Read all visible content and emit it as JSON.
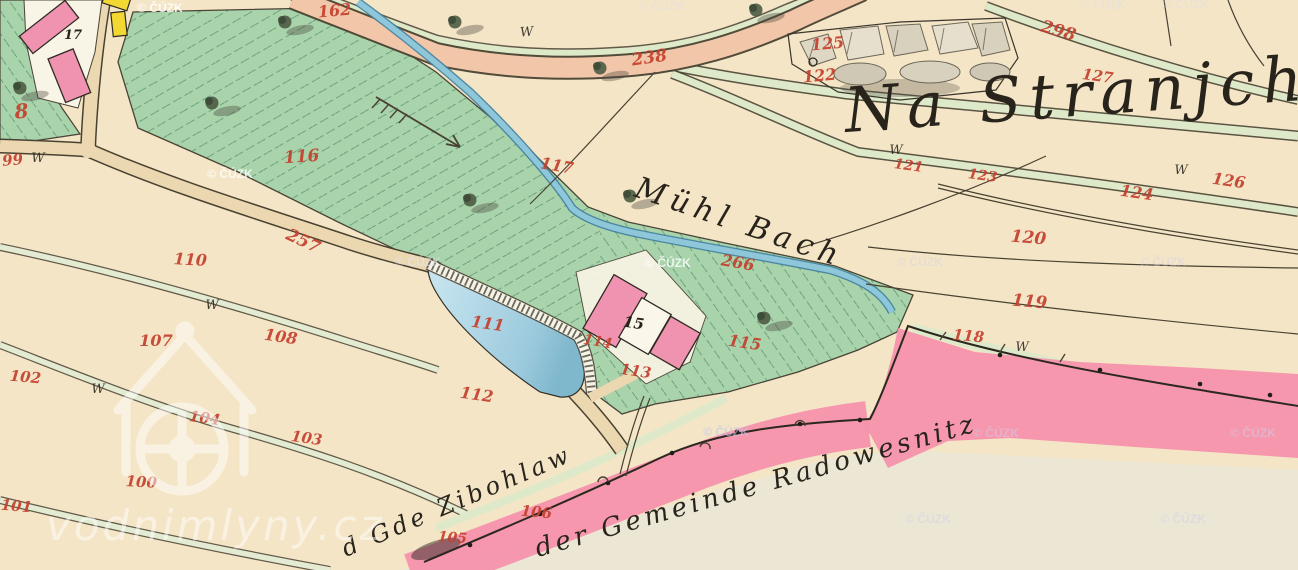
{
  "map": {
    "colors": {
      "cream": "#f4e5c6",
      "gray_field": "#ece6d4",
      "meadow": "#a9d3ab",
      "verge": "#dde9c9",
      "road_tan": "#ebd7b0",
      "road_salmon": "#f2c7a9",
      "stream": "#8ec6da",
      "stream_edge": "#40809d",
      "pond_light": "#c9e6f0",
      "pond_dark": "#7fb7cd",
      "pink_boundary": "#f692ac",
      "building_pink": "#ef93b0",
      "building_yellow": "#f3d832",
      "ink": "#494232",
      "red_label": "#c4402e",
      "black_label": "#26231d"
    },
    "place_labels": [
      {
        "text": "Na Stranjch",
        "x": 846,
        "y": 132,
        "rot": -4,
        "size": 62,
        "ls": 8
      },
      {
        "text": "Mühl Bach",
        "x": 633,
        "y": 196,
        "rot": 19,
        "size": 30,
        "ls": 6
      },
      {
        "text": "der Gemeinde Radowesnitz",
        "x": 538,
        "y": 557,
        "rot": -16,
        "size": 26,
        "ls": 4
      },
      {
        "text": "d Gde Zibohlaw",
        "x": 346,
        "y": 557,
        "rot": -23,
        "size": 24,
        "ls": 4
      }
    ],
    "parcel_numbers_red": [
      {
        "t": "8",
        "x": 22,
        "y": 118,
        "r": -5,
        "s": 20
      },
      {
        "t": "99",
        "x": 13,
        "y": 165,
        "r": -5,
        "s": 15
      },
      {
        "t": "162",
        "x": 335,
        "y": 16,
        "r": -5,
        "s": 16
      },
      {
        "t": "238",
        "x": 650,
        "y": 63,
        "r": -8,
        "s": 17
      },
      {
        "t": "298",
        "x": 1057,
        "y": 36,
        "r": 16,
        "s": 17
      },
      {
        "t": "125",
        "x": 828,
        "y": 49,
        "r": -5,
        "s": 16
      },
      {
        "t": "122",
        "x": 820,
        "y": 81,
        "r": -5,
        "s": 16
      },
      {
        "t": "127",
        "x": 1097,
        "y": 81,
        "r": 8,
        "s": 15
      },
      {
        "t": "121",
        "x": 908,
        "y": 170,
        "r": 8,
        "s": 14
      },
      {
        "t": "123",
        "x": 982,
        "y": 180,
        "r": 8,
        "s": 14
      },
      {
        "t": "126",
        "x": 1228,
        "y": 186,
        "r": 8,
        "s": 16
      },
      {
        "t": "124",
        "x": 1136,
        "y": 198,
        "r": 8,
        "s": 16
      },
      {
        "t": "120",
        "x": 1028,
        "y": 243,
        "r": 5,
        "s": 17
      },
      {
        "t": "119",
        "x": 1029,
        "y": 307,
        "r": 5,
        "s": 17
      },
      {
        "t": "118",
        "x": 968,
        "y": 341,
        "r": 5,
        "s": 15
      },
      {
        "t": "117",
        "x": 556,
        "y": 171,
        "r": 10,
        "s": 16
      },
      {
        "t": "116",
        "x": 302,
        "y": 162,
        "r": -4,
        "s": 17
      },
      {
        "t": "266",
        "x": 737,
        "y": 268,
        "r": 10,
        "s": 16
      },
      {
        "t": "257",
        "x": 301,
        "y": 246,
        "r": 25,
        "s": 17
      },
      {
        "t": "110",
        "x": 190,
        "y": 265,
        "r": 3,
        "s": 16
      },
      {
        "t": "107",
        "x": 156,
        "y": 346,
        "r": 0,
        "s": 16
      },
      {
        "t": "108",
        "x": 280,
        "y": 342,
        "r": 8,
        "s": 16
      },
      {
        "t": "102",
        "x": 25,
        "y": 382,
        "r": 5,
        "s": 15
      },
      {
        "t": "104",
        "x": 204,
        "y": 423,
        "r": 8,
        "s": 15
      },
      {
        "t": "103",
        "x": 306,
        "y": 443,
        "r": 8,
        "s": 15
      },
      {
        "t": "100",
        "x": 141,
        "y": 487,
        "r": 3,
        "s": 15
      },
      {
        "t": "101",
        "x": 16,
        "y": 511,
        "r": 5,
        "s": 15
      },
      {
        "t": "106",
        "x": 536,
        "y": 517,
        "r": 5,
        "s": 15
      },
      {
        "t": "105",
        "x": 452,
        "y": 542,
        "r": 5,
        "s": 14
      },
      {
        "t": "112",
        "x": 476,
        "y": 400,
        "r": 8,
        "s": 16
      },
      {
        "t": "111",
        "x": 487,
        "y": 329,
        "r": 8,
        "s": 16
      },
      {
        "t": "114",
        "x": 597,
        "y": 346,
        "r": 10,
        "s": 14
      },
      {
        "t": "113",
        "x": 635,
        "y": 376,
        "r": 8,
        "s": 15
      },
      {
        "t": "115",
        "x": 744,
        "y": 348,
        "r": 8,
        "s": 16
      }
    ],
    "building_numbers_black": [
      {
        "t": "17",
        "x": 73,
        "y": 39,
        "r": 0,
        "s": 13
      },
      {
        "t": "15",
        "x": 633,
        "y": 328,
        "r": 8,
        "s": 15
      }
    ],
    "meadow_symbols_w": [
      {
        "x": 527,
        "y": 36,
        "r": -5
      },
      {
        "x": 38,
        "y": 162,
        "r": 0
      },
      {
        "x": 212,
        "y": 309,
        "r": 0
      },
      {
        "x": 98,
        "y": 393,
        "r": 0
      },
      {
        "x": 896,
        "y": 154,
        "r": 0
      },
      {
        "x": 1181,
        "y": 174,
        "r": 0
      },
      {
        "x": 1022,
        "y": 351,
        "r": 0
      }
    ],
    "trees": [
      {
        "x": 20,
        "y": 88
      },
      {
        "x": 212,
        "y": 103
      },
      {
        "x": 285,
        "y": 22
      },
      {
        "x": 455,
        "y": 22
      },
      {
        "x": 600,
        "y": 68
      },
      {
        "x": 756,
        "y": 10
      },
      {
        "x": 470,
        "y": 200
      },
      {
        "x": 630,
        "y": 196
      },
      {
        "x": 764,
        "y": 318
      }
    ],
    "watermarks": {
      "cuzk_text": "© ČÚZK",
      "site_text": "vodnimlyny.cz",
      "cuzk": [
        {
          "x": 160,
          "y": 8,
          "o": 0.85,
          "c": "#ffffff"
        },
        {
          "x": 230,
          "y": 174,
          "o": 0.8,
          "c": "#ffffff"
        },
        {
          "x": 418,
          "y": 262,
          "o": 0.55,
          "c": "#e9e9f4"
        },
        {
          "x": 668,
          "y": 263,
          "o": 0.8,
          "c": "#ffffff"
        },
        {
          "x": 920,
          "y": 262,
          "o": 0.4,
          "c": "#cfcfe8"
        },
        {
          "x": 1163,
          "y": 262,
          "o": 0.4,
          "c": "#cfcfe8"
        },
        {
          "x": 726,
          "y": 432,
          "o": 0.6,
          "c": "#bcc6ee"
        },
        {
          "x": 996,
          "y": 433,
          "o": 0.5,
          "c": "#cfcfe8"
        },
        {
          "x": 1253,
          "y": 433,
          "o": 0.5,
          "c": "#cfcfe8"
        },
        {
          "x": 928,
          "y": 519,
          "o": 0.45,
          "c": "#cfcfe8"
        },
        {
          "x": 1183,
          "y": 519,
          "o": 0.45,
          "c": "#cfcfe8"
        },
        {
          "x": 662,
          "y": 6,
          "o": 0.35,
          "c": "#dcdcf0"
        },
        {
          "x": 1103,
          "y": 5,
          "o": 0.35,
          "c": "#dcdcf0"
        },
        {
          "x": 1186,
          "y": 4,
          "o": 0.35,
          "c": "#dcdcf0"
        }
      ]
    }
  }
}
